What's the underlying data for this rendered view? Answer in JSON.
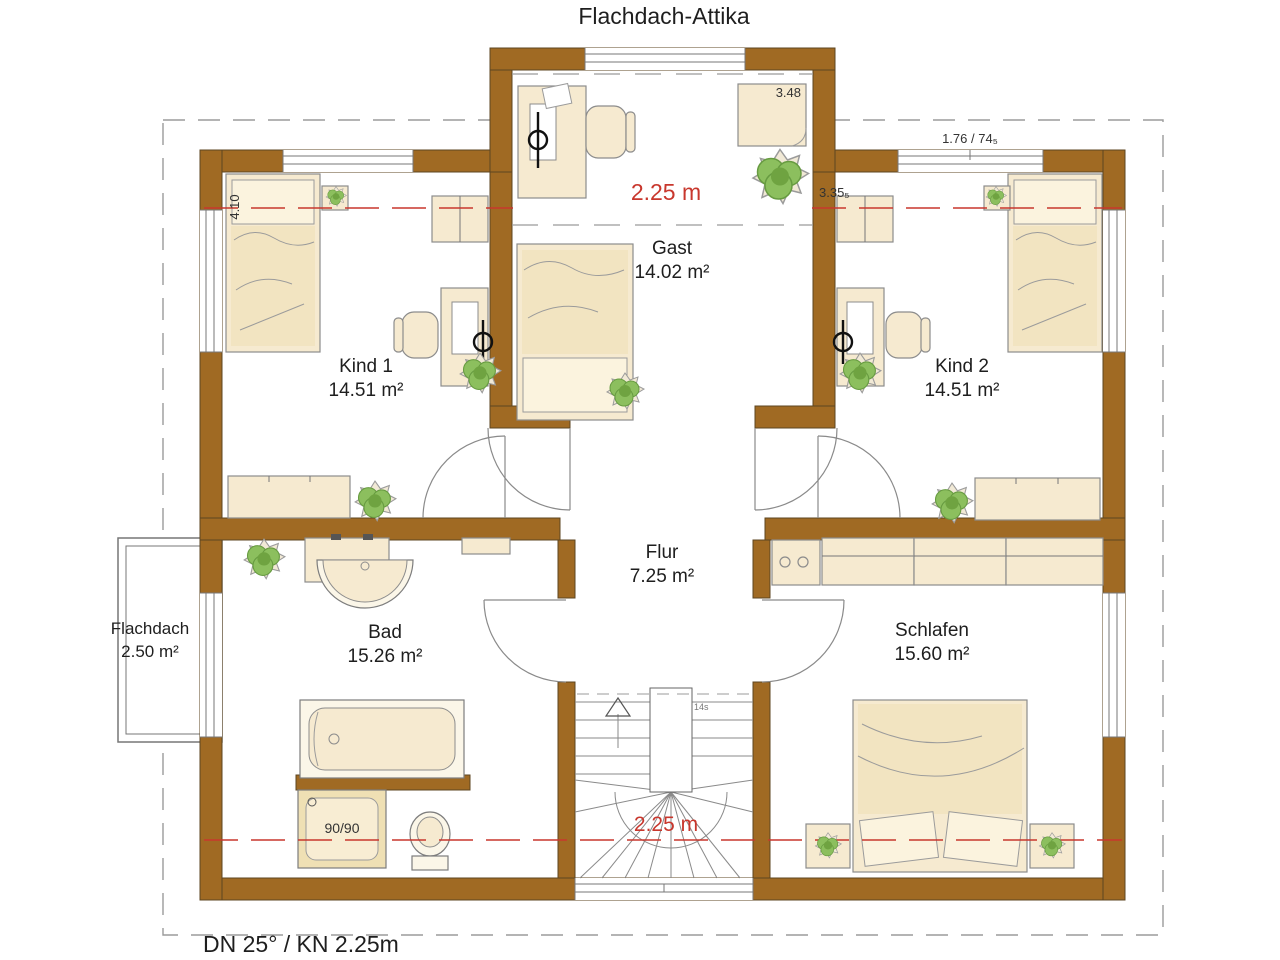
{
  "title": "Flachdach-Attika",
  "footer": "DN 25° / KN 2.25m",
  "rooms": {
    "kind1": {
      "name": "Kind 1",
      "area": "14.51 m²"
    },
    "kind2": {
      "name": "Kind 2",
      "area": "14.51 m²"
    },
    "gast": {
      "name": "Gast",
      "area": "14.02 m²"
    },
    "bad": {
      "name": "Bad",
      "area": "15.26 m²"
    },
    "flur": {
      "name": "Flur",
      "area": "7.25 m²"
    },
    "schlafen": {
      "name": "Schlafen",
      "area": "15.60 m²"
    },
    "flachdach": {
      "name": "Flachdach",
      "area": "2.50 m²"
    }
  },
  "height_lines": {
    "top": "2.25 m",
    "bottom": "2.25 m"
  },
  "dimensions": {
    "gast_closet": "3.48",
    "kind2_wall": "3.35₅",
    "kind2_window": "1.76 / 74₅",
    "kind1_depth": "4.10",
    "shower": "90/90",
    "stair_steps": "14s"
  },
  "colors": {
    "wall_brown": "#A06A23",
    "accent_red": "#C8372D",
    "furniture_cream": "#F6EAD0",
    "plant_green": "#8CBF5E"
  }
}
